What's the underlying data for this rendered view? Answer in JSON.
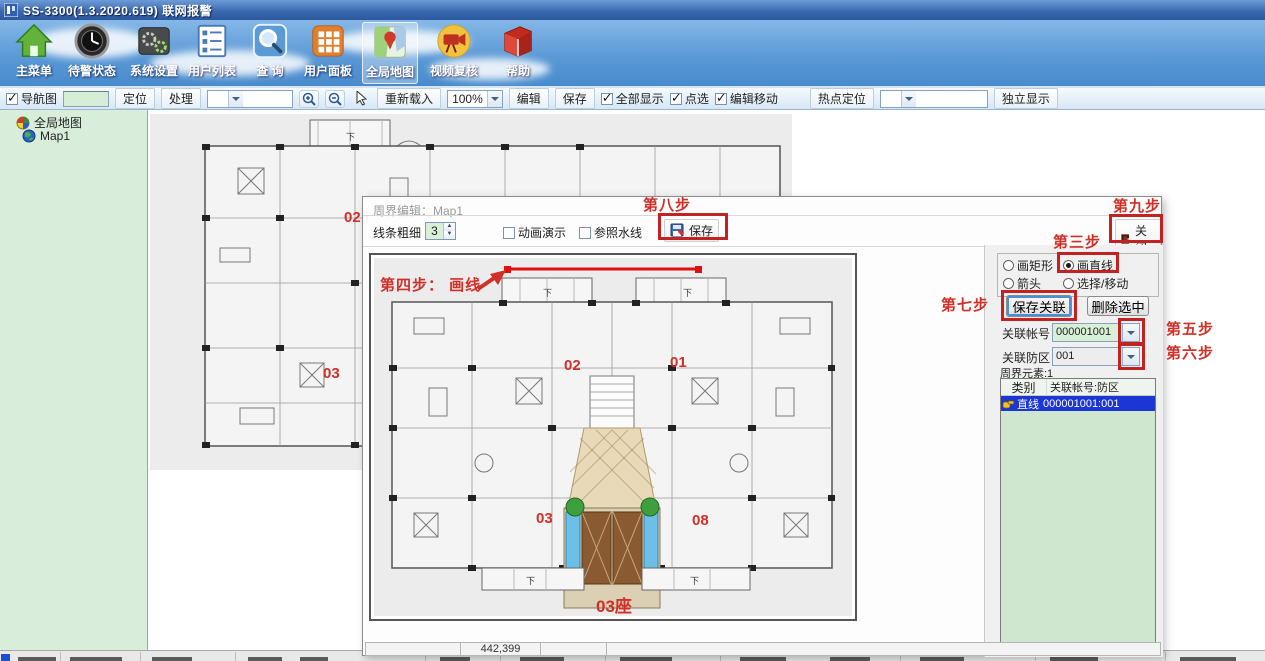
{
  "window": {
    "title": "SS-3300(1.3.2020.619) 联网报警"
  },
  "main_toolbar": {
    "items": [
      {
        "label": "主菜单"
      },
      {
        "label": "待警状态"
      },
      {
        "label": "系统设置"
      },
      {
        "label": "用户列表"
      },
      {
        "label": "查 询"
      },
      {
        "label": "用户面板"
      },
      {
        "label": "全局地图"
      },
      {
        "label": "视频复核"
      },
      {
        "label": "帮助"
      }
    ]
  },
  "map_toolbar": {
    "nav_checkbox": "导航图",
    "locate_button": "定位",
    "handle_button": "处理",
    "reload_button": "重新载入",
    "zoom_value": "100%",
    "edit_button": "编辑",
    "save_button": "保存",
    "show_all_checkbox": "全部显示",
    "point_select_checkbox": "点选",
    "edit_move_checkbox": "编辑移动",
    "hotspot_button": "热点定位",
    "standalone_button": "独立显示"
  },
  "tree": {
    "items": [
      {
        "label": "全局地图"
      },
      {
        "label": "Map1"
      }
    ]
  },
  "background_plan": {
    "unit_02": "02",
    "unit_03": "03",
    "down": "下",
    "watermark": "Sou"
  },
  "dialog": {
    "title": "周界编辑：Map1",
    "toolbar": {
      "line_width_label": "线条粗细",
      "line_width_value": "3",
      "animation_checkbox": "动画演示",
      "waterline_checkbox": "参照水线",
      "save_button": "保存",
      "close_button": "关闭"
    },
    "steps": {
      "step3": "第三步",
      "step4": "第四步： 画线",
      "step5": "第五步",
      "step6": "第六步",
      "step7": "第七步",
      "step8": "第八步",
      "step9": "第九步"
    },
    "plan": {
      "unit_01": "01",
      "unit_02": "02",
      "unit_03": "03",
      "unit_08": "08",
      "building": "03座",
      "down": "下",
      "watermark": "SouFun"
    },
    "panel": {
      "radios": [
        {
          "label": "画矩形"
        },
        {
          "label": "画直线"
        },
        {
          "label": "箭头"
        },
        {
          "label": "选择/移动"
        }
      ],
      "save_assoc_button": "保存关联",
      "delete_selected_button": "删除选中",
      "assoc_account_label": "关联帐号",
      "assoc_account_value": "000001001",
      "assoc_zone_label": "关联防区",
      "assoc_zone_value": "001",
      "elements_label": "周界元素:1",
      "list": {
        "header_type": "类别",
        "header_assoc": "关联帐号:防区",
        "rows": [
          {
            "type": "直线",
            "assoc": "000001001:001"
          }
        ]
      }
    },
    "statusbar": {
      "coords": "442,399"
    }
  }
}
